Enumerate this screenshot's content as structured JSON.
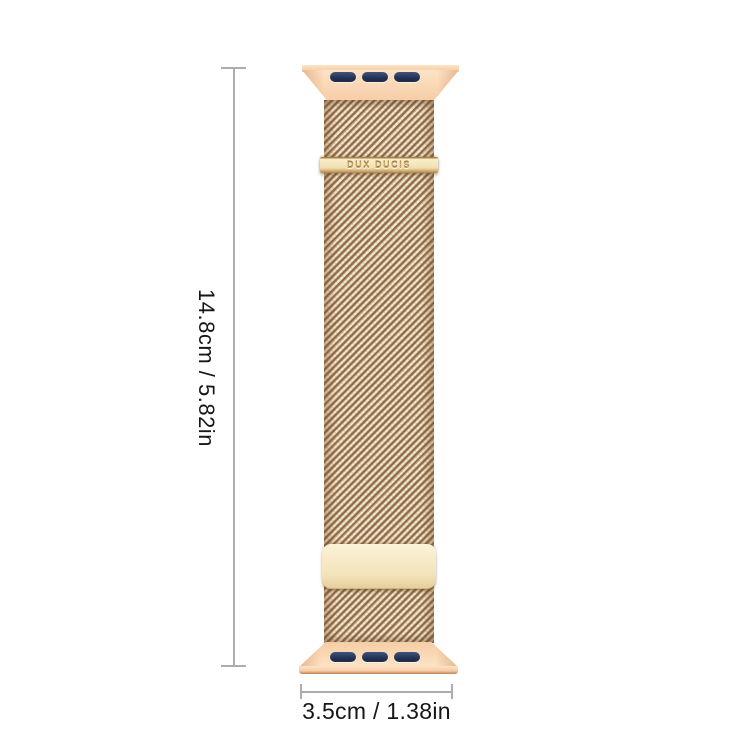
{
  "canvas": {
    "width": 750,
    "height": 750,
    "background": "#ffffff"
  },
  "product": {
    "name": "Milanese loop watch band, rose gold",
    "brand_text": "DUX DUCIS",
    "colors": {
      "lug_light": "#fde3c6",
      "lug_mid": "#f6cda6",
      "lug_edge": "#c0814f",
      "slot_dark": "#202e4e",
      "slot_light": "#41547e",
      "mesh_light": "#f3e9d3",
      "mesh_mid": "#c9a87e",
      "mesh_dark": "#8a6b4e",
      "clasp_face": "#f0deb0",
      "clasp_edge": "#a8824e",
      "plate_light": "#fbf2d8",
      "plate_dark": "#e6cf9f"
    }
  },
  "annotations": {
    "height_label": "14.8cm / 5.82in",
    "width_label": "3.5cm / 1.38in",
    "line_color": "#a9aeb4",
    "text_color": "#161616"
  }
}
